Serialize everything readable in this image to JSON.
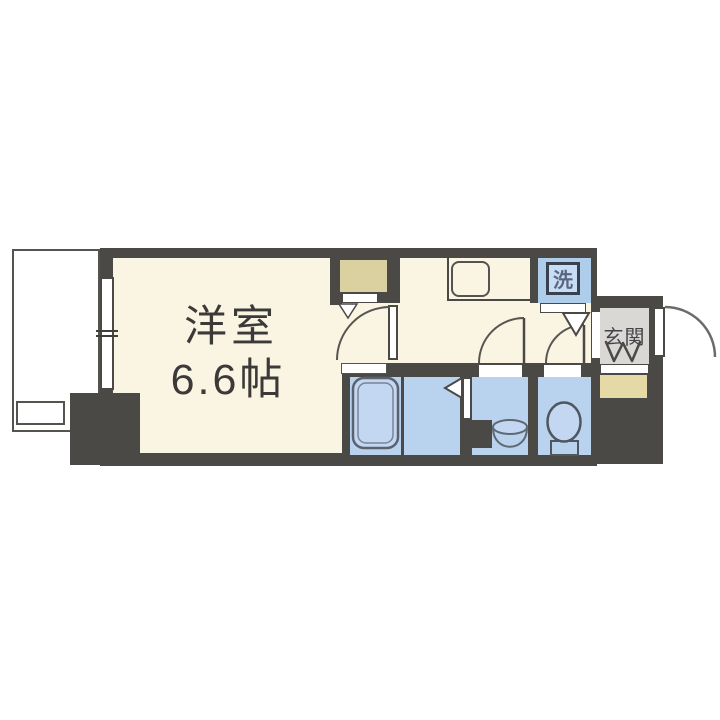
{
  "floorplan": {
    "type": "apartment-1K-floorplan",
    "main_room": {
      "name": "洋室",
      "size": "6.6帖"
    },
    "washer": {
      "label": "洗"
    },
    "entrance": {
      "label": "玄関"
    },
    "colors": {
      "wall": "#4a4946",
      "floor_cream": "#faf4e3",
      "wet_area_blue": "#b9d2ed",
      "washer_blue": "#aecdea",
      "bathtub_blue": "#c3d7f2",
      "closet_beige": "#dbd0a0",
      "shoe_cabinet_beige": "#e5d9a6",
      "entrance_gray": "#d9d8d5",
      "background": "#ffffff"
    }
  }
}
